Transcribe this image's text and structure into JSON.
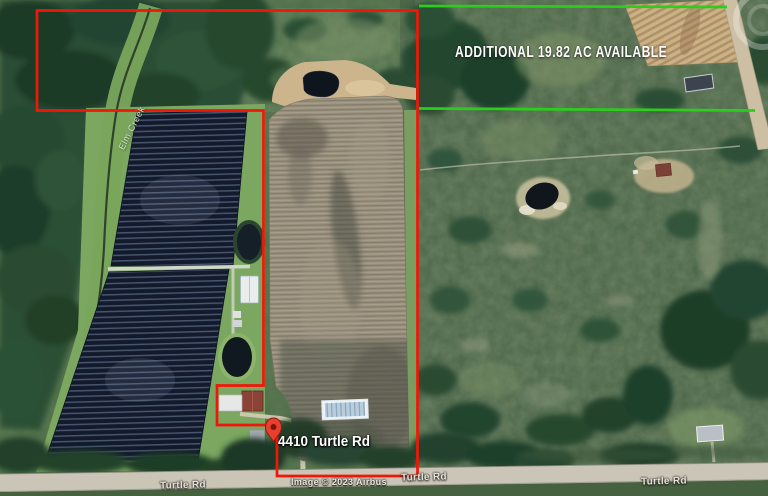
{
  "map": {
    "annotation_available": "ADDITIONAL 19.82 AC AVAILABLE",
    "pin_label": "4410 Turtle Rd",
    "creek_label": "Elm Creek",
    "attribution": "Image © 2023 Airbus",
    "road_labels": [
      "Turtle Rd",
      "Turtle Rd",
      "Turtle Rd"
    ],
    "icons": {
      "pin": "location-pin",
      "compass": "compass-ring"
    },
    "colors": {
      "boundary_red": "#f11708",
      "boundary_green": "#2bce1b",
      "pin_red": "#e8402f",
      "label_white": "#ffffff"
    }
  }
}
